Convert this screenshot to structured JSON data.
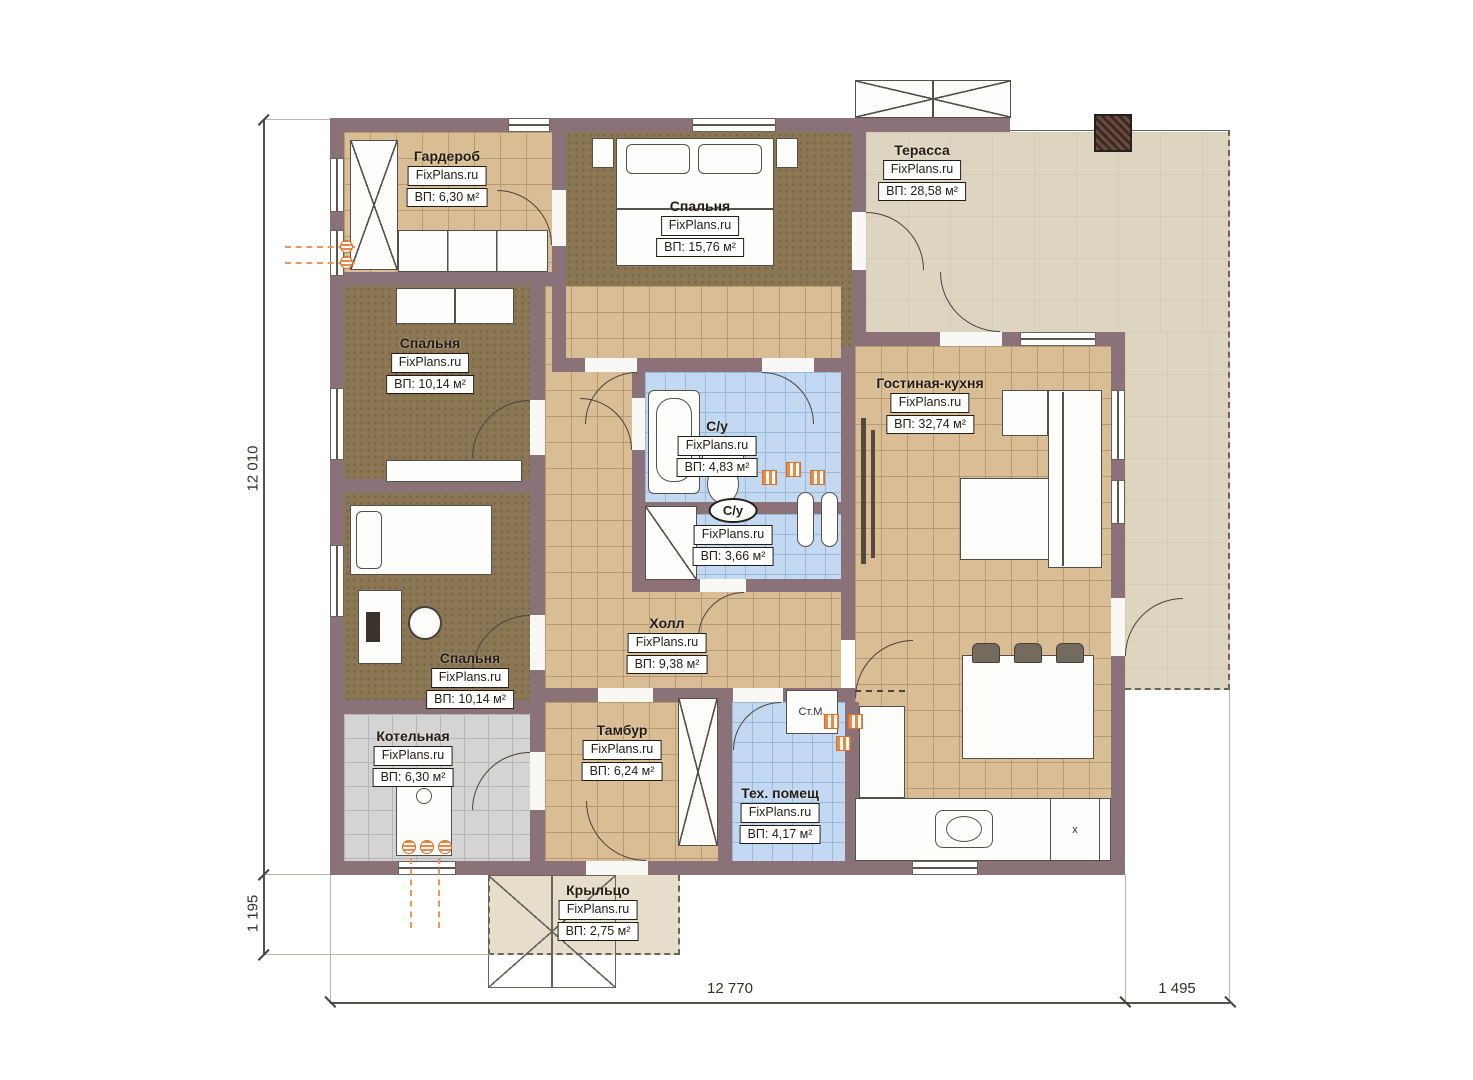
{
  "plan_title": "Floor plan",
  "brand": "FixPlans.ru",
  "rooms": [
    {
      "name": "Гардероб",
      "brand": "FixPlans.ru",
      "area": "ВП: 6,30 м²"
    },
    {
      "name": "Спальня",
      "brand": "FixPlans.ru",
      "area": "ВП: 15,76 м²"
    },
    {
      "name": "Терасса",
      "brand": "FixPlans.ru",
      "area": "ВП: 28,58 м²"
    },
    {
      "name": "Спальня",
      "brand": "FixPlans.ru",
      "area": "ВП: 10,14 м²"
    },
    {
      "name": "С/у",
      "brand": "FixPlans.ru",
      "area": "ВП: 4,83 м²"
    },
    {
      "name": "Гостиная-кухня",
      "brand": "FixPlans.ru",
      "area": "ВП: 32,74 м²"
    },
    {
      "name": "С/у",
      "brand": "FixPlans.ru",
      "area": "ВП: 3,66 м²"
    },
    {
      "name": "Холл",
      "brand": "FixPlans.ru",
      "area": "ВП: 9,38 м²"
    },
    {
      "name": "Спальня",
      "brand": "FixPlans.ru",
      "area": "ВП: 10,14 м²"
    },
    {
      "name": "Котельная",
      "brand": "FixPlans.ru",
      "area": "ВП: 6,30 м²"
    },
    {
      "name": "Тамбур",
      "brand": "FixPlans.ru",
      "area": "ВП: 6,24 м²"
    },
    {
      "name": "Тех. помещ",
      "brand": "FixPlans.ru",
      "area": "ВП: 4,17 м²"
    },
    {
      "name": "Крыльцо",
      "brand": "FixPlans.ru",
      "area": "ВП: 2,75 м²"
    }
  ],
  "annotations": {
    "washing_machine": "Ст.М.",
    "stove_mark": "x"
  },
  "dimensions": {
    "left_total": "12 010",
    "left_porch": "1 195",
    "bottom_main": "12 770",
    "bottom_terrace": "1 495"
  },
  "colors": {
    "wall": "#8b7279",
    "tile_tan": "#d9bd95",
    "tile_blue": "#c2d9f1",
    "tile_gray": "#d4d4d4",
    "carpet_brown": "#8c7755",
    "terrace": "#ded5c0",
    "heating_orange": "#ec8a45"
  }
}
